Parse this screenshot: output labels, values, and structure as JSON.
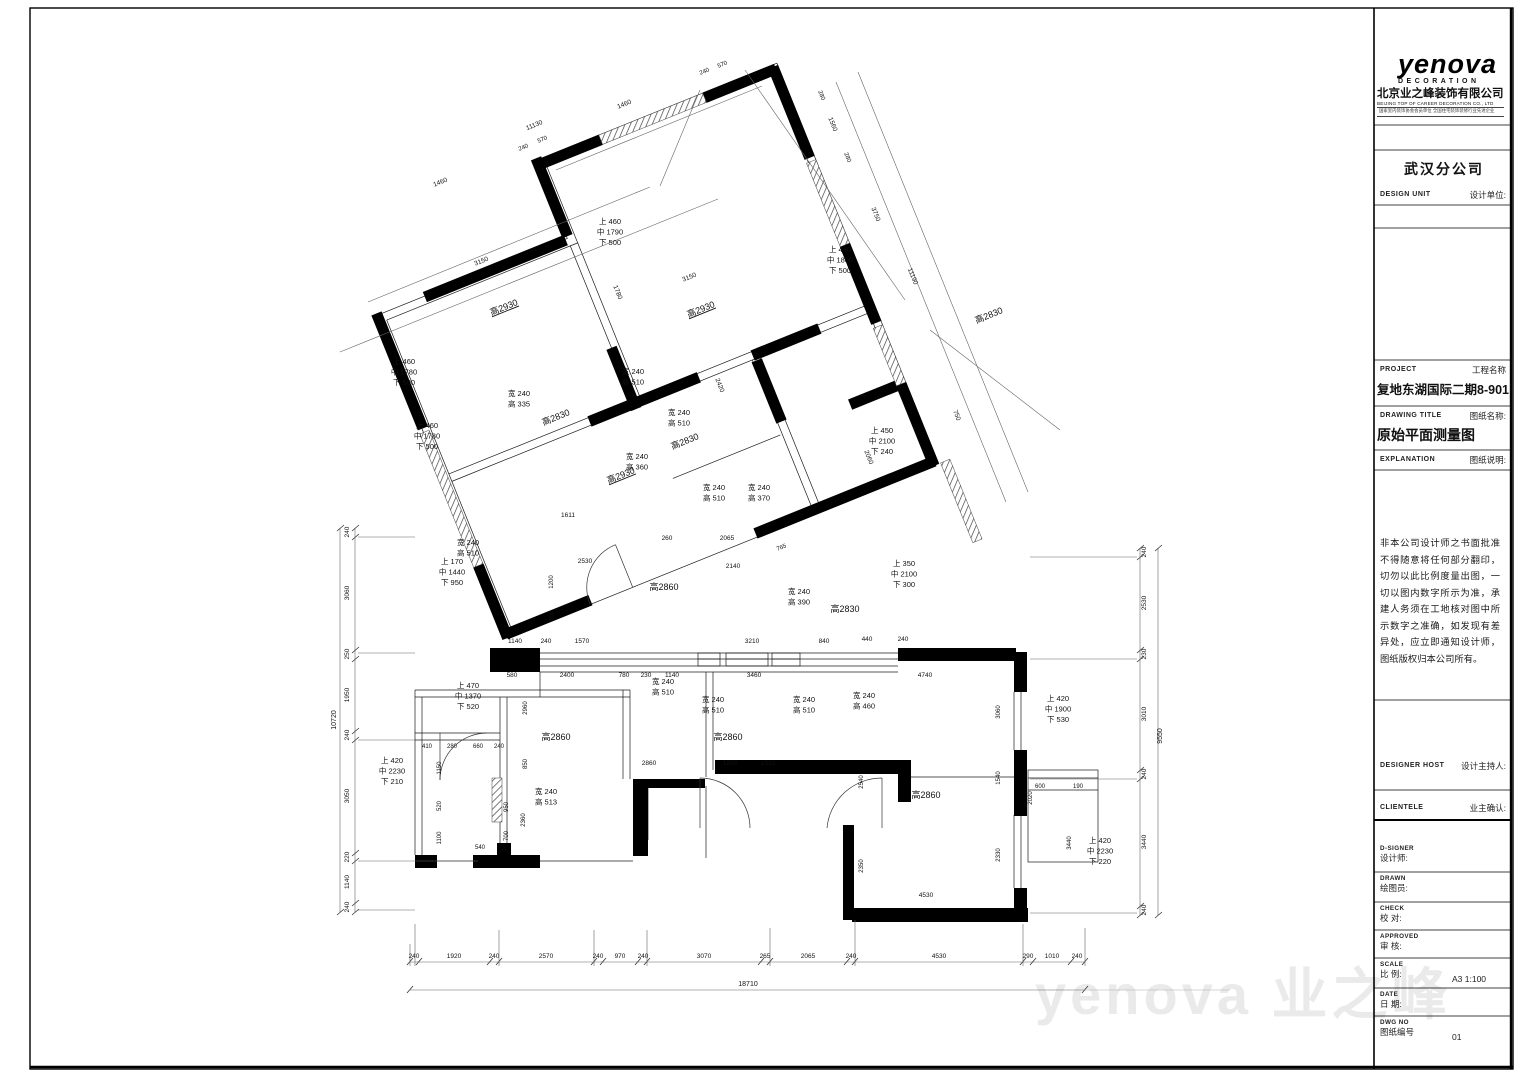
{
  "header": {
    "logo": "yenova",
    "logo_sub": "DECORATION",
    "company_cn": "北京业之峰装饰有限公司",
    "company_en": "BEIJING TOP OF CAREER DECORATION CO., LTD",
    "company_cert": "国家室内装饰协会会员单位 全国住宅装饰装修行业先进企业",
    "branch": "武汉分公司"
  },
  "fields": {
    "design_unit_en": "DESIGN UNIT",
    "design_unit_cn": "设计单位:",
    "project_en": "PROJECT",
    "project_cn": "工程名称",
    "project_value": "复地东湖国际二期8-901",
    "drawing_title_en": "DRAWING TITLE",
    "drawing_title_cn": "图纸名称:",
    "drawing_title_value": "原始平面测量图",
    "explanation_en": "EXPLANATION",
    "explanation_cn": "图纸说明:",
    "explanation_body": "非本公司设计师之书面批准不得随意将任何部分翻印，切勿以此比例度量出图，一切以图内数字所示为准，承建人务须在工地核对图中所示数字之准确，如发现有差异处，应立即通知设计师，图纸版权归本公司所有。",
    "designer_host_en": "DESIGNER HOST",
    "designer_host_cn": "设计主持人:",
    "clientele_en": "CLIENTELE",
    "clientele_cn": "业主确认:",
    "designer_en": "D-SIGNER",
    "designer_cn": "设计师:",
    "drawn_en": "DRAWN",
    "drawn_cn": "绘图员:",
    "check_en": "CHECK",
    "check_cn": "校  对:",
    "approved_en": "APPROVED",
    "approved_cn": "审  核:",
    "scale_en": "SCALE",
    "scale_cn": "比  例:",
    "scale_value": "A3  1:100",
    "date_en": "DATE",
    "date_cn": "日  期:",
    "dwg_en": "DWG NO",
    "dwg_cn": "图纸编号",
    "dwg_value": "01"
  },
  "watermark": {
    "text": "yenova 业之峰"
  },
  "plan": {
    "labels": [
      {
        "x": 505,
        "y": 310,
        "t": "高2930",
        "r": -22,
        "s": 9,
        "u": 1
      },
      {
        "x": 702,
        "y": 312,
        "t": "高2930",
        "r": -22,
        "s": 9,
        "u": 1
      },
      {
        "x": 557,
        "y": 420,
        "t": "高2830",
        "r": -22,
        "s": 9
      },
      {
        "x": 686,
        "y": 444,
        "t": "高2830",
        "r": -22,
        "s": 9
      },
      {
        "x": 622,
        "y": 478,
        "t": "高2930",
        "r": -22,
        "s": 9,
        "u": 1
      },
      {
        "x": 990,
        "y": 318,
        "t": "高2830",
        "r": -22,
        "s": 9
      },
      {
        "x": 845,
        "y": 612,
        "t": "高2830",
        "s": 9
      },
      {
        "x": 664,
        "y": 590,
        "t": "高2860",
        "s": 9
      },
      {
        "x": 556,
        "y": 740,
        "t": "高2860",
        "s": 9
      },
      {
        "x": 728,
        "y": 740,
        "t": "高2860",
        "s": 9
      },
      {
        "x": 926,
        "y": 798,
        "t": "高2860",
        "s": 9
      },
      {
        "x": 519,
        "y": 396,
        "l": [
          "宽 240",
          "高 335"
        ]
      },
      {
        "x": 633,
        "y": 374,
        "l": [
          "宽 240",
          "高 510"
        ]
      },
      {
        "x": 679,
        "y": 415,
        "l": [
          "宽 240",
          "高 510"
        ]
      },
      {
        "x": 637,
        "y": 459,
        "l": [
          "宽 240",
          "高 360"
        ]
      },
      {
        "x": 714,
        "y": 490,
        "l": [
          "宽 240",
          "高 510"
        ]
      },
      {
        "x": 759,
        "y": 490,
        "l": [
          "宽 240",
          "高 370"
        ]
      },
      {
        "x": 799,
        "y": 594,
        "l": [
          "宽 240",
          "高 390"
        ]
      },
      {
        "x": 663,
        "y": 684,
        "l": [
          "宽 240",
          "高 510"
        ]
      },
      {
        "x": 713,
        "y": 702,
        "l": [
          "宽 240",
          "高 510"
        ]
      },
      {
        "x": 804,
        "y": 702,
        "l": [
          "宽 240",
          "高 510"
        ]
      },
      {
        "x": 864,
        "y": 698,
        "l": [
          "宽 240",
          "高 460"
        ]
      },
      {
        "x": 546,
        "y": 794,
        "l": [
          "宽 240",
          "高 513"
        ]
      },
      {
        "x": 468,
        "y": 545,
        "l": [
          "宽 240",
          "高 510"
        ]
      },
      {
        "x": 610,
        "y": 224,
        "l": [
          "上 460",
          "中 1790",
          "下 500"
        ]
      },
      {
        "x": 840,
        "y": 252,
        "l": [
          "上 440",
          "中 1800",
          "下 500"
        ]
      },
      {
        "x": 404,
        "y": 364,
        "l": [
          "上 460",
          "中 1780",
          "下 500"
        ]
      },
      {
        "x": 427,
        "y": 428,
        "l": [
          "上 460",
          "中 1780",
          "下 500"
        ]
      },
      {
        "x": 452,
        "y": 564,
        "l": [
          "上 170",
          "中 1440",
          "下 950"
        ]
      },
      {
        "x": 882,
        "y": 433,
        "l": [
          "上 450",
          "中 2100",
          "下 240"
        ]
      },
      {
        "x": 904,
        "y": 566,
        "l": [
          "上 350",
          "中 2100",
          "下 300"
        ]
      },
      {
        "x": 468,
        "y": 688,
        "l": [
          "上 470",
          "中 1370",
          "下 520"
        ]
      },
      {
        "x": 1058,
        "y": 701,
        "l": [
          "上 420",
          "中 1900",
          "下 530"
        ]
      },
      {
        "x": 392,
        "y": 763,
        "l": [
          "上 420",
          "中 2230",
          "下 210"
        ]
      },
      {
        "x": 1100,
        "y": 843,
        "l": [
          "上 420",
          "中 2230",
          "下 220"
        ]
      },
      {
        "x": 414,
        "y": 958,
        "t": "240",
        "s": 6.5
      },
      {
        "x": 454,
        "y": 958,
        "t": "1920",
        "s": 6.5
      },
      {
        "x": 494,
        "y": 958,
        "t": "240",
        "s": 6.5
      },
      {
        "x": 546,
        "y": 958,
        "t": "2570",
        "s": 6.5
      },
      {
        "x": 598,
        "y": 958,
        "t": "240",
        "s": 6.5
      },
      {
        "x": 620,
        "y": 958,
        "t": "970",
        "s": 6.5
      },
      {
        "x": 643,
        "y": 958,
        "t": "240",
        "s": 6.5
      },
      {
        "x": 704,
        "y": 958,
        "t": "3070",
        "s": 6.5
      },
      {
        "x": 765,
        "y": 958,
        "t": "265",
        "s": 6.5
      },
      {
        "x": 808,
        "y": 958,
        "t": "2065",
        "s": 6.5
      },
      {
        "x": 851,
        "y": 958,
        "t": "240",
        "s": 6.5
      },
      {
        "x": 939,
        "y": 958,
        "t": "4530",
        "s": 6.5
      },
      {
        "x": 1028,
        "y": 958,
        "t": "290",
        "s": 6.5
      },
      {
        "x": 1052,
        "y": 958,
        "t": "1010",
        "s": 6.5
      },
      {
        "x": 1077,
        "y": 958,
        "t": "240",
        "s": 6.5
      },
      {
        "x": 748,
        "y": 986,
        "t": "18710",
        "s": 7
      },
      {
        "x": 349,
        "y": 532,
        "t": "240",
        "r": -90,
        "s": 6.5
      },
      {
        "x": 349,
        "y": 593,
        "t": "3060",
        "r": -90,
        "s": 6.5
      },
      {
        "x": 349,
        "y": 654,
        "t": "250",
        "r": -90,
        "s": 6.5
      },
      {
        "x": 349,
        "y": 695,
        "t": "1950",
        "r": -90,
        "s": 6.5
      },
      {
        "x": 349,
        "y": 735,
        "t": "240",
        "r": -90,
        "s": 6.5
      },
      {
        "x": 349,
        "y": 796,
        "t": "3050",
        "r": -90,
        "s": 6.5
      },
      {
        "x": 349,
        "y": 857,
        "t": "220",
        "r": -90,
        "s": 6.5
      },
      {
        "x": 349,
        "y": 882,
        "t": "1140",
        "r": -90,
        "s": 6.5
      },
      {
        "x": 349,
        "y": 907,
        "t": "240",
        "r": -90,
        "s": 6.5
      },
      {
        "x": 336,
        "y": 720,
        "t": "10720",
        "r": -90,
        "s": 7
      },
      {
        "x": 1146,
        "y": 552,
        "t": "240",
        "r": -90,
        "s": 6.5
      },
      {
        "x": 1146,
        "y": 603,
        "t": "2530",
        "r": -90,
        "s": 6.5
      },
      {
        "x": 1146,
        "y": 654,
        "t": "230",
        "r": -90,
        "s": 6.5
      },
      {
        "x": 1146,
        "y": 714,
        "t": "3010",
        "r": -90,
        "s": 6.5
      },
      {
        "x": 1146,
        "y": 774,
        "t": "240",
        "r": -90,
        "s": 6.5
      },
      {
        "x": 1146,
        "y": 842,
        "t": "3440",
        "r": -90,
        "s": 6.5
      },
      {
        "x": 1146,
        "y": 910,
        "t": "240",
        "r": -90,
        "s": 6.5
      },
      {
        "x": 1162,
        "y": 736,
        "t": "9550",
        "r": -90,
        "s": 7
      },
      {
        "x": 515,
        "y": 643,
        "t": "1140",
        "s": 6.5
      },
      {
        "x": 546,
        "y": 643,
        "t": "240",
        "s": 6.5
      },
      {
        "x": 582,
        "y": 643,
        "t": "1570",
        "s": 6.5
      },
      {
        "x": 752,
        "y": 643,
        "t": "3210",
        "s": 6.5
      },
      {
        "x": 824,
        "y": 643,
        "t": "840",
        "s": 6.5
      },
      {
        "x": 867,
        "y": 641,
        "t": "440",
        "s": 6.5
      },
      {
        "x": 903,
        "y": 641,
        "t": "240",
        "s": 6.5
      },
      {
        "x": 512,
        "y": 677,
        "t": "580",
        "s": 6.5
      },
      {
        "x": 567,
        "y": 677,
        "t": "2400",
        "s": 6.5
      },
      {
        "x": 624,
        "y": 677,
        "t": "780",
        "s": 6.5
      },
      {
        "x": 646,
        "y": 677,
        "t": "230",
        "s": 6.5
      },
      {
        "x": 672,
        "y": 677,
        "t": "1140",
        "s": 6.5
      },
      {
        "x": 754,
        "y": 677,
        "t": "3460",
        "s": 6.5
      },
      {
        "x": 925,
        "y": 677,
        "t": "4740",
        "s": 6.5
      },
      {
        "x": 585,
        "y": 563,
        "t": "2530",
        "s": 6.5
      },
      {
        "x": 568,
        "y": 517,
        "t": "1611",
        "s": 6.5
      },
      {
        "x": 667,
        "y": 540,
        "t": "260",
        "s": 6.5
      },
      {
        "x": 727,
        "y": 540,
        "t": "2065",
        "s": 6.5
      },
      {
        "x": 733,
        "y": 568,
        "t": "2140",
        "s": 6.5
      },
      {
        "x": 649,
        "y": 765,
        "t": "2860",
        "s": 6.5
      },
      {
        "x": 730,
        "y": 765,
        "t": "1250",
        "s": 6.5
      },
      {
        "x": 768,
        "y": 765,
        "t": "1010",
        "s": 6.5
      },
      {
        "x": 427,
        "y": 748,
        "t": "410",
        "s": 6
      },
      {
        "x": 452,
        "y": 748,
        "t": "280",
        "s": 6
      },
      {
        "x": 478,
        "y": 748,
        "t": "660",
        "s": 6
      },
      {
        "x": 499,
        "y": 748,
        "t": "240",
        "s": 6
      },
      {
        "x": 480,
        "y": 849,
        "t": "540",
        "s": 6
      },
      {
        "x": 926,
        "y": 897,
        "t": "4530",
        "s": 6.5
      },
      {
        "x": 1040,
        "y": 788,
        "t": "600",
        "s": 6
      },
      {
        "x": 1078,
        "y": 788,
        "t": "190",
        "s": 6
      },
      {
        "x": 1032,
        "y": 798,
        "t": "2020",
        "r": -90,
        "s": 6
      },
      {
        "x": 553,
        "y": 582,
        "t": "1200",
        "r": -90,
        "s": 6
      },
      {
        "x": 554,
        "y": 616,
        "t": "900",
        "r": -90,
        "s": 6
      },
      {
        "x": 527,
        "y": 708,
        "t": "2960",
        "r": -90,
        "s": 6
      },
      {
        "x": 527,
        "y": 764,
        "t": "850",
        "r": -90,
        "s": 6
      },
      {
        "x": 508,
        "y": 807,
        "t": "950",
        "r": -90,
        "s": 6
      },
      {
        "x": 508,
        "y": 836,
        "t": "700",
        "r": -90,
        "s": 6
      },
      {
        "x": 525,
        "y": 820,
        "t": "2360",
        "r": -90,
        "s": 6
      },
      {
        "x": 441,
        "y": 768,
        "t": "1150",
        "r": -90,
        "s": 6
      },
      {
        "x": 441,
        "y": 806,
        "t": "520",
        "r": -90,
        "s": 6
      },
      {
        "x": 441,
        "y": 838,
        "t": "1100",
        "r": -90,
        "s": 6
      },
      {
        "x": 863,
        "y": 782,
        "t": "2540",
        "r": -90,
        "s": 6
      },
      {
        "x": 863,
        "y": 866,
        "t": "2350",
        "r": -90,
        "s": 6
      },
      {
        "x": 1000,
        "y": 778,
        "t": "1540",
        "r": -90,
        "s": 6
      },
      {
        "x": 1000,
        "y": 855,
        "t": "2330",
        "r": -90,
        "s": 6
      },
      {
        "x": 1000,
        "y": 712,
        "t": "3060",
        "r": -90,
        "s": 6
      },
      {
        "x": 1071,
        "y": 843,
        "t": "3440",
        "r": -90,
        "s": 6
      },
      {
        "x": 535,
        "y": 127,
        "t": "11130",
        "r": -22,
        "s": 6.5
      },
      {
        "x": 625,
        "y": 106,
        "t": "1460",
        "r": -22,
        "s": 6.5
      },
      {
        "x": 441,
        "y": 184,
        "t": "1460",
        "r": -22,
        "s": 6.5
      },
      {
        "x": 524,
        "y": 149,
        "t": "240",
        "r": -22,
        "s": 6
      },
      {
        "x": 543,
        "y": 141,
        "t": "570",
        "r": -22,
        "s": 6
      },
      {
        "x": 705,
        "y": 73,
        "t": "240",
        "r": -22,
        "s": 6
      },
      {
        "x": 723,
        "y": 66,
        "t": "570",
        "r": -22,
        "s": 6
      },
      {
        "x": 911,
        "y": 277,
        "t": "11190",
        "r": 68,
        "s": 6.5
      },
      {
        "x": 874,
        "y": 215,
        "t": "3750",
        "r": 68,
        "s": 6.5
      },
      {
        "x": 831,
        "y": 125,
        "t": "1560",
        "r": 68,
        "s": 6.5
      },
      {
        "x": 820,
        "y": 96,
        "t": "280",
        "r": 68,
        "s": 6
      },
      {
        "x": 846,
        "y": 158,
        "t": "280",
        "r": 68,
        "s": 6
      },
      {
        "x": 690,
        "y": 279,
        "t": "3150",
        "r": -22,
        "s": 6.5
      },
      {
        "x": 482,
        "y": 263,
        "t": "3150",
        "r": -22,
        "s": 6.5
      },
      {
        "x": 616,
        "y": 293,
        "t": "1780",
        "r": 68,
        "s": 6.5
      },
      {
        "x": 867,
        "y": 458,
        "t": "2060",
        "r": 68,
        "s": 6.5
      },
      {
        "x": 955,
        "y": 416,
        "t": "750",
        "r": 68,
        "s": 6.5
      },
      {
        "x": 782,
        "y": 549,
        "t": "765",
        "r": -22,
        "s": 6
      },
      {
        "x": 718,
        "y": 386,
        "t": "2420",
        "r": 68,
        "s": 6.5
      }
    ]
  }
}
